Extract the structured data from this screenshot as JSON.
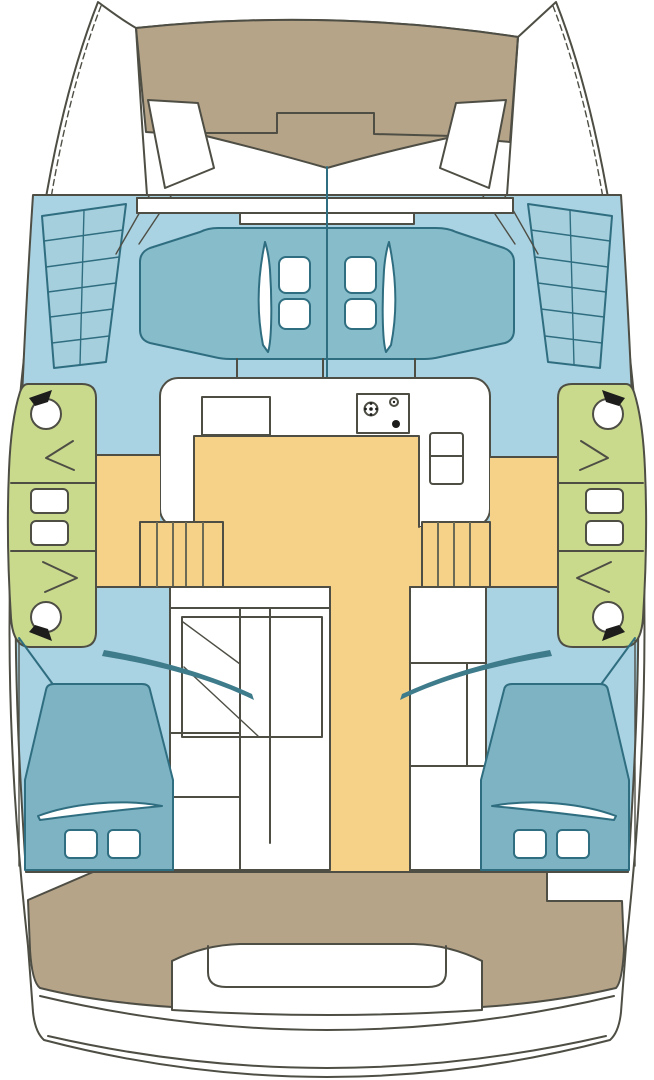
{
  "meta": {
    "title": "Catamaran accommodation plan (top view)",
    "description": "Two-hull sailing catamaran deck and cabin layout diagram"
  },
  "colors": {
    "background": "#ffffff",
    "hull": "#ffffff",
    "outline": "#4e4e45",
    "teak": "#b6a489",
    "deck": "#a9d2e2",
    "coachroof": "#87bcca",
    "bed": "#7db3c3",
    "teal_line": "#2f6e80",
    "head": "#c9da8d",
    "sole": "#f6d289",
    "steps": "#a6cfdd",
    "stair_line": "#6a6a55",
    "glass": "#3e7b8b",
    "black": "#1d1d1b"
  },
  "areas": {
    "trampoline": "bow trampoline and anchor locker",
    "coachroof": "coachroof with four deck hatches",
    "galley": "galley with sink unit, two-burner stove and fridge",
    "saloon_sole": "saloon sole with twin companionway stairs and aft corridor",
    "port_head": "port heads: two WC compartments and twin washbasins",
    "starboard_head": "starboard heads: two WC compartments and twin washbasins",
    "port_aft_cabin": "port aft double berth with two pillows",
    "starboard_aft_cabin": "starboard aft double berth with two pillows",
    "port_hull_interior": "port hull cabin furniture",
    "starboard_hull_interior": "starboard hull cabin furniture",
    "cockpit": "aft cockpit with U-shaped bench seat",
    "transom": "transom steps and swim platform"
  },
  "fixtures": {
    "deck_hatches": 4,
    "toilets": 4,
    "washbasins": 4,
    "pillows": 4,
    "stove_burners": 2,
    "companionway_stairs": 2,
    "boarding_step_pads": 2
  }
}
